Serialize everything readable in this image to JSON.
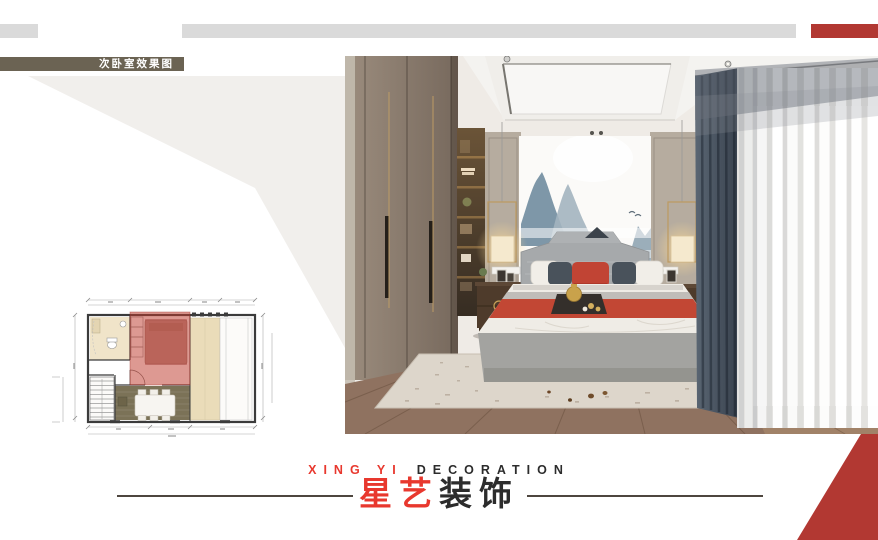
{
  "slide": {
    "background": "#ffffff",
    "accent_red": "#b23832",
    "accent_gray": "#dadada",
    "light_wedge": "#f1efec"
  },
  "header": {
    "title": "次卧室效果图",
    "bar_color": "#6b6353",
    "text_color": "#ffffff"
  },
  "floor_plan": {
    "highlight_color": "rgba(189,60,46,0.52)",
    "dining_floor": "#7b7257",
    "balcony_fill": "#eadcb9"
  },
  "photo": {
    "accent_red": "#c14434",
    "wood_floor": "#8a6e5b",
    "wardrobe": "#8a7c6e",
    "curtain_dark": "#46505e",
    "headboard_gray": "#a6a9ab"
  },
  "branding": {
    "latin_red": "XING YI",
    "latin_dark": "DECORATION",
    "cn_red": "星艺",
    "cn_dark": "装饰",
    "red": "#e8382e",
    "dark": "#2c2c2c"
  }
}
